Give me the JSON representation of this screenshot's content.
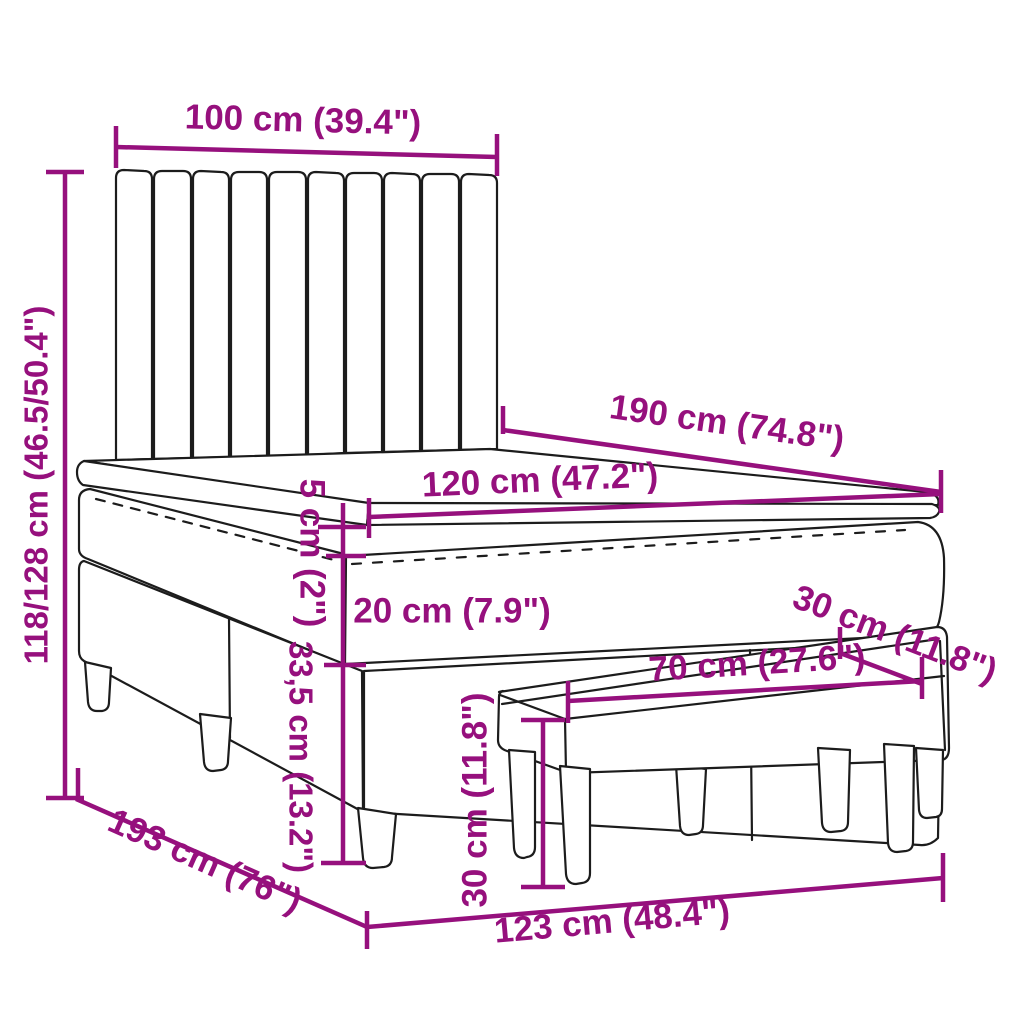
{
  "diagram": {
    "type": "furniture-dimension-diagram",
    "subject": "box spring bed with headboard, mattress topper and bench",
    "labels": {
      "headboard_width": "100 cm (39.4\")",
      "bed_height": "118/128 cm (46.5/50.4\")",
      "bed_length": "190 cm (74.8\")",
      "mattress_width": "120 cm (47.2\")",
      "topper_height": "5 cm (2\")",
      "mattress_height": "20 cm (7.9\")",
      "bench_depth": "30 cm (11.8\")",
      "box_height": "33,5 cm (13.2\")",
      "bench_length": "70 cm (27.6\")",
      "bench_height": "30 cm (11.8\")",
      "frame_length": "193 cm (76\")",
      "base_length": "123 cm (48.4\")"
    },
    "colors": {
      "dimension": "#96107D",
      "line_art": "#1C1C1C",
      "background": "#FFFFFF"
    }
  }
}
